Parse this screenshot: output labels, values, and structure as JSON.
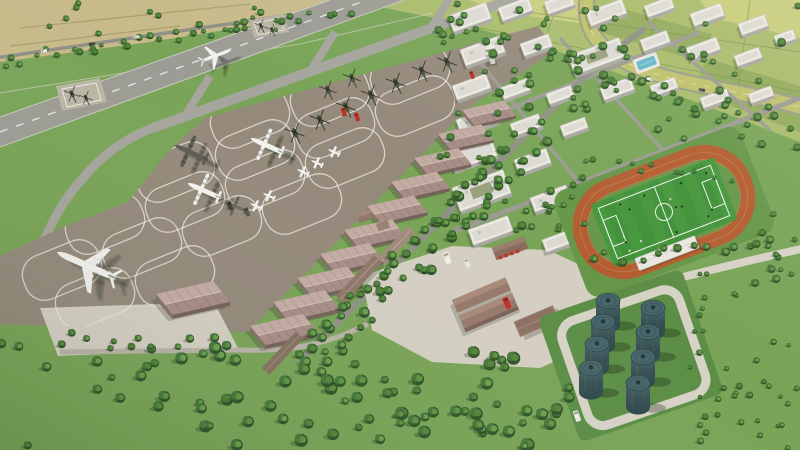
{
  "scene": {
    "type": "3d-aerial-architectural-rendering",
    "subject": "Aerial 3D rendering of an airbase: main runway with parallel taxiway and holding pads, large apron with parked airliner, transport aircraft, trainers and helicopters, diagonal row of hangars, tree-lined campus of white buildings with control tower and swimming pool, soccer pitch with running track, service yard with fire trucks, fuel tank farm, farmland and a curving highway",
    "time_of_day": "daytime"
  },
  "palette": {
    "base": "#79a457",
    "grass_dark": "#669648",
    "farm_tan": "#c8ba89",
    "farm_green": "#a9bc6d",
    "farm_lime": "#c7cd7d",
    "farm_olive": "#93ab5d",
    "highway": "#bfc06c",
    "road": "#8f9086",
    "road_light": "#d6d2c6",
    "concrete": "#d4cfc2",
    "runway": "#9c9c95",
    "taxiway": "#a5a59d",
    "apron": "#94897b",
    "marking": "#ece9dd",
    "hangar_roof_light": "#c3aba2",
    "hangar_roof_dark": "#a78d86",
    "hangar_wall": "#846e68",
    "bldg_roof": "#eceae3",
    "bldg_inset": "#dcdad2",
    "bldg_wall": "#a8a8a1",
    "tree_dark": "#2f5428",
    "tree_mid": "#46783a",
    "tree_light": "#5f9340",
    "track": "#b35d2f",
    "pitch": "#3f9038",
    "pitch_light": "#4a9b41",
    "pool": "#62b6c9",
    "tank_top": "#47666a",
    "tank_mid": "#355054",
    "tank_deep": "#2e474b",
    "red": "#c23227",
    "white_ac": "#f1f1ee",
    "gray_ac": "#5c5c54",
    "heli": "#47543b",
    "shadow": "rgba(28,38,20,0.32)"
  },
  "objects": {
    "runway": 1,
    "parallel_taxiway": 1,
    "holding_pads": 2,
    "apron_parking_loops": 17,
    "hangars": 10,
    "detached_hangar": 1,
    "helicopters": 13,
    "transport_aircraft": 4,
    "trainer_aircraft": 5,
    "airliner": 1,
    "aircraft_on_runway": 1,
    "campus_buildings": 30,
    "control_tower": 1,
    "swimming_pool": 1,
    "soccer_pitch": 1,
    "running_track": 1,
    "grandstand": 1,
    "fuel_tanks": 8,
    "fire_trucks": 3,
    "trucks_and_vans": 6,
    "service_buildings": 8,
    "farm_fields": true,
    "curved_highway": 1,
    "orchard": true
  }
}
